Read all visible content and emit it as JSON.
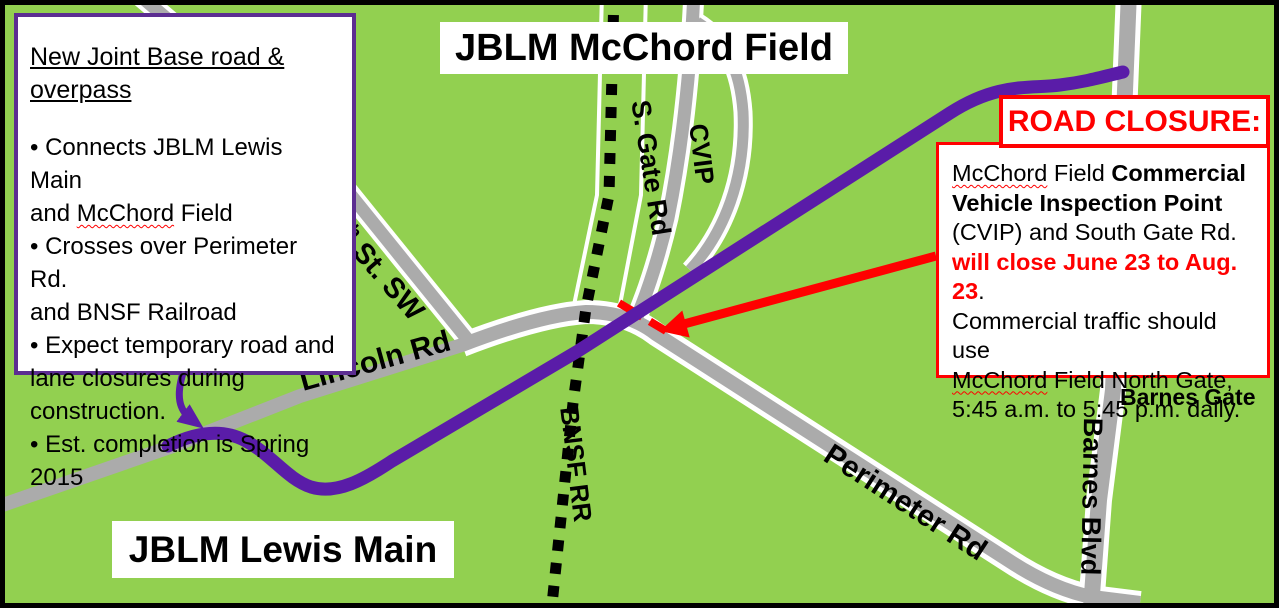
{
  "colors": {
    "bg": "#92D050",
    "road": "#ABABAB",
    "casing": "#FFFFFF",
    "rail": "#000000",
    "purple": "#5A1CA8",
    "purple_border": "#5C2D91",
    "red": "#FF0000",
    "ink": "#000000"
  },
  "region_labels": {
    "north": "JBLM McChord Field",
    "south": "JBLM Lewis Main"
  },
  "info_box": {
    "title": "New Joint Base road & overpass",
    "lines": [
      [
        {
          "t": "• Connects JBLM Lewis Main",
          "s": ""
        }
      ],
      [
        {
          "t": "and ",
          "s": ""
        },
        {
          "t": "McChord",
          "s": "sq"
        },
        {
          "t": " Field",
          "s": ""
        }
      ],
      [
        {
          "t": "• Crosses over Perimeter Rd.",
          "s": ""
        }
      ],
      [
        {
          "t": "and BNSF Railroad",
          "s": ""
        }
      ],
      [
        {
          "t": "• Expect temporary road and",
          "s": ""
        }
      ],
      [
        {
          "t": "lane closures during",
          "s": ""
        }
      ],
      [
        {
          "t": "construction.",
          "s": ""
        }
      ],
      [
        {
          "t": "• Est. completion is Spring 2015",
          "s": ""
        }
      ]
    ]
  },
  "closure": {
    "header": "ROAD CLOSURE:",
    "lines": [
      [
        {
          "t": "McChord",
          "s": "sq"
        },
        {
          "t": " Field ",
          "s": ""
        },
        {
          "t": "Commercial",
          "s": "b"
        }
      ],
      [
        {
          "t": "Vehicle Inspection Point",
          "s": "b"
        }
      ],
      [
        {
          "t": "(CVIP) and South Gate Rd.",
          "s": ""
        }
      ],
      [
        {
          "t": "will close June 23 to Aug. 23",
          "s": "rb"
        },
        {
          "t": ".",
          "s": ""
        }
      ],
      [
        {
          "t": "Commercial traffic should use",
          "s": ""
        }
      ],
      [
        {
          "t": "McChord",
          "s": "sq"
        },
        {
          "t": " Field North Gate,",
          "s": ""
        }
      ],
      [
        {
          "t": "5:45 a.m. to 5:45 p.m. daily.",
          "s": ""
        }
      ]
    ]
  },
  "road_labels": {
    "lincoln": "Lincoln Rd",
    "st150_base": "150",
    "st150_sup": "th",
    "st150_rest": " St. SW",
    "s_gate": "S. Gate Rd",
    "cvip": "CVIP",
    "bnsf": "BNSF RR",
    "perimeter": "Perimeter Rd",
    "barnes_blvd": "Barnes Blvd",
    "barnes_gate": "Barnes Gate"
  }
}
